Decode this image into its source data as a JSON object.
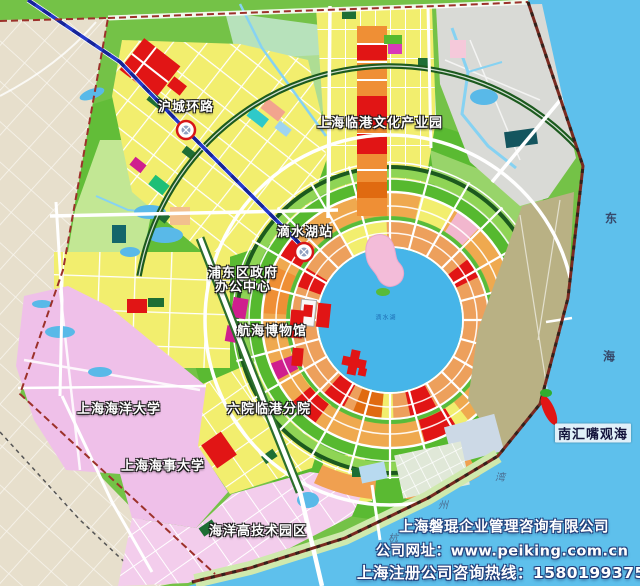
{
  "map": {
    "labels": {
      "hucheng_ring_road": "沪城环路",
      "culture_park": "上海临港文化产业园",
      "dishui_lake_station": "滴水湖站",
      "pudong_gov_line1": "浦东区政府",
      "pudong_gov_line2": "办公中心",
      "maritime_museum": "航海博物馆",
      "ocean_university": "上海海洋大学",
      "sixth_hospital_branch": "六院临港分院",
      "maritime_university": "上海海事大学",
      "marine_hightech_park": "海洋高技术园区",
      "nanhuizui_seaview": "南汇嘴观海"
    },
    "sea_text": {
      "east_char": "东",
      "sea_char": "海",
      "bay_char1": "杭",
      "bay_char2": "州",
      "bay_char3": "湾"
    },
    "lake": {
      "name": "滴水湖"
    },
    "footer": {
      "company": "上海磐琨企业管理咨询有限公司",
      "website_label": "公司网址：",
      "website_url": "www.peiking.com.cn",
      "hotline": "上海注册公司咨询热线：15801993753"
    },
    "colors": {
      "sea": "#5ec0ec",
      "lake": "#46b5e9",
      "land": "#74c247",
      "park_bright": "#56b92f",
      "park_pale": "#cdeb9e",
      "pale_mint": "#bfe5c8",
      "block_yellow": "#f2ee6e",
      "block_orange": "#ef8f35",
      "ring_base": "#eda05c",
      "ring_base2": "#efa94f",
      "block_red": "#e11515",
      "magenta": "#cf1f8e",
      "campus_pink": "#efc0e9",
      "pink_grid": "#f3cdec",
      "outside_beige": "#e7dfcc",
      "reserved_grey": "#d9dad6",
      "headland_tan": "#b9b184",
      "dark_ring": "#1c5a1e",
      "metro_blue": "#2438c8",
      "boundary_red": "#9c312a",
      "coast_line": "#7a2a20",
      "stream": "#86d2f2",
      "dark_green_block": "#1e6e34",
      "road_white": "#ffffff"
    }
  }
}
